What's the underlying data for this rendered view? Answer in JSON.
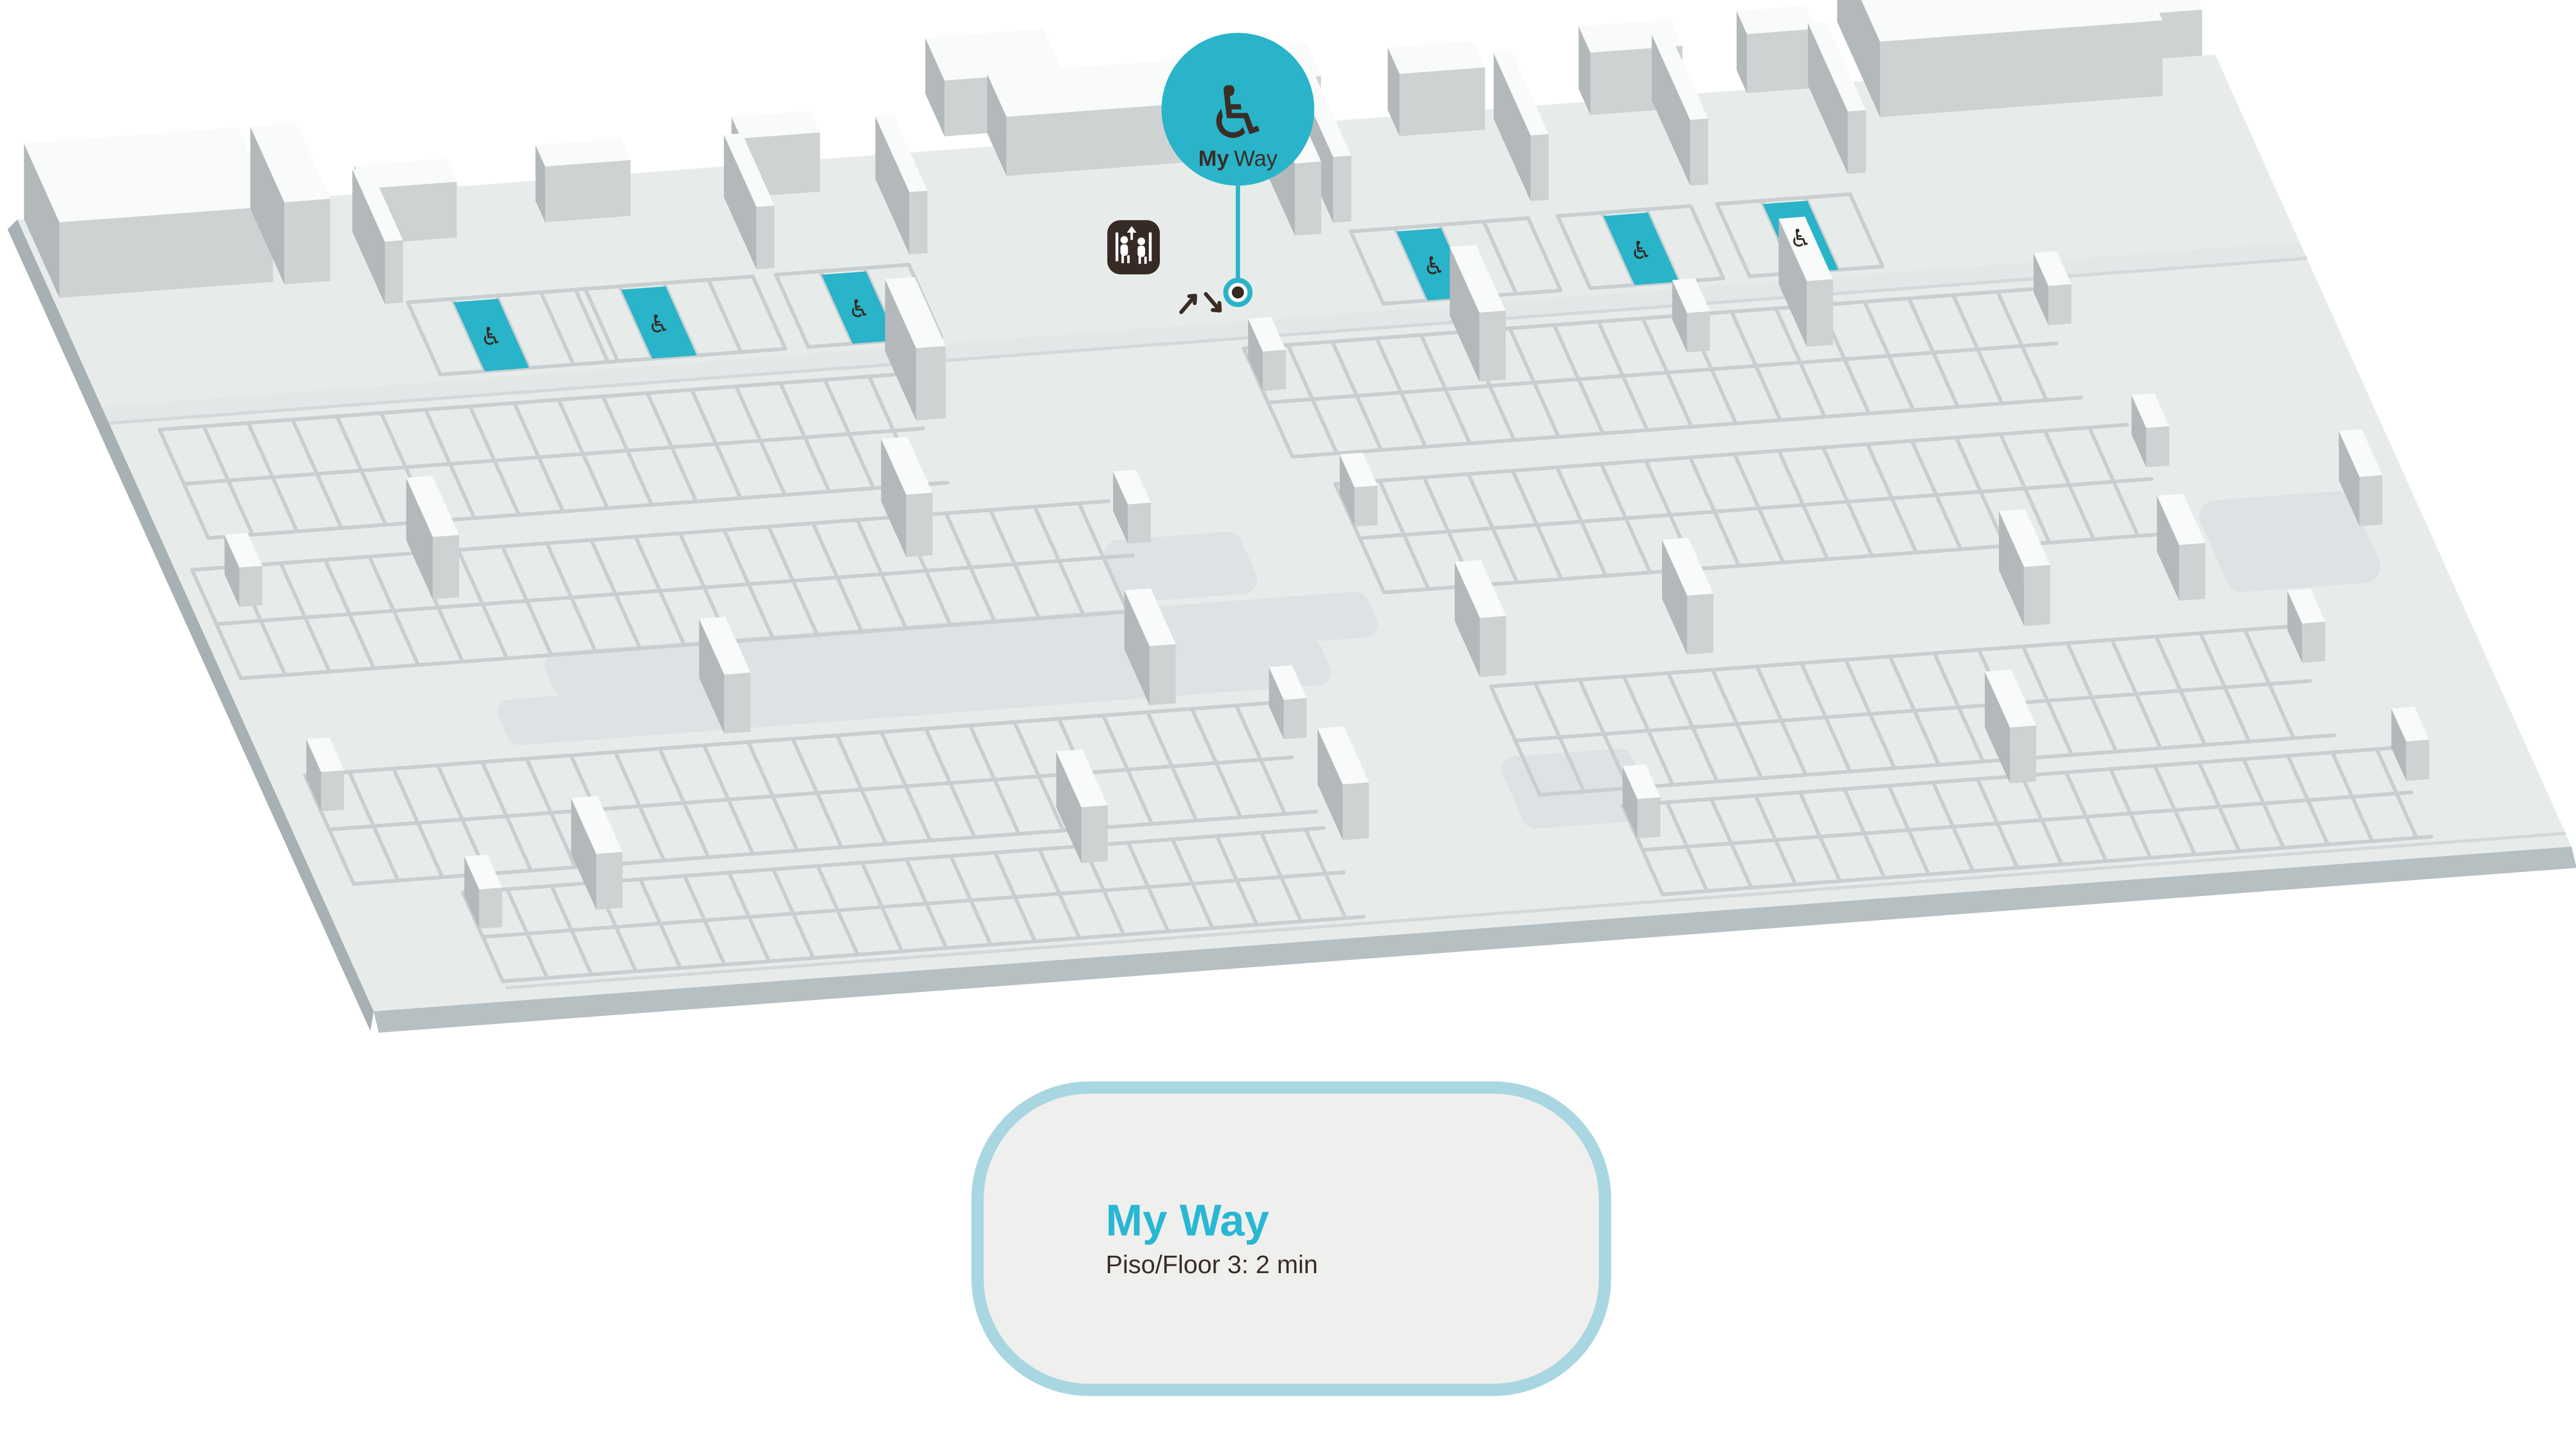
{
  "page": {
    "background": "#ffffff"
  },
  "marker": {
    "icon": "wheelchair-icon",
    "icon_glyph": "♿",
    "label_bold": "My",
    "label_regular": "Way",
    "color": "#29b4c9",
    "text_color": "#3a2d26"
  },
  "map": {
    "floor_color": "#e7eceb",
    "stall_line_color": "#c9cfd1",
    "structure_top_color": "#f9fafa",
    "structure_side_color": "#b3b9ba",
    "structure_front_color": "#cfd2d2",
    "road_line_color": "#d3d9da",
    "ramp_color": "#dde3e4",
    "slab_edge_color": "#b6bfc1",
    "accessible_spot_color": "#29b4c9",
    "accessible_spot_glyph": "♿",
    "accessible_spot_count": 6,
    "elevator_icon": "elevator-icon",
    "elevator_box_color": "#352a24",
    "direction_arrows_icon": "up-down-arrows-icon"
  },
  "info_card": {
    "title": "My Way",
    "subtitle": "Piso/Floor 3: 2 min",
    "title_color": "#29b7d3",
    "text_color": "#3a2d26",
    "border_color": "#a9d7e1",
    "background_color": "#efefee"
  }
}
